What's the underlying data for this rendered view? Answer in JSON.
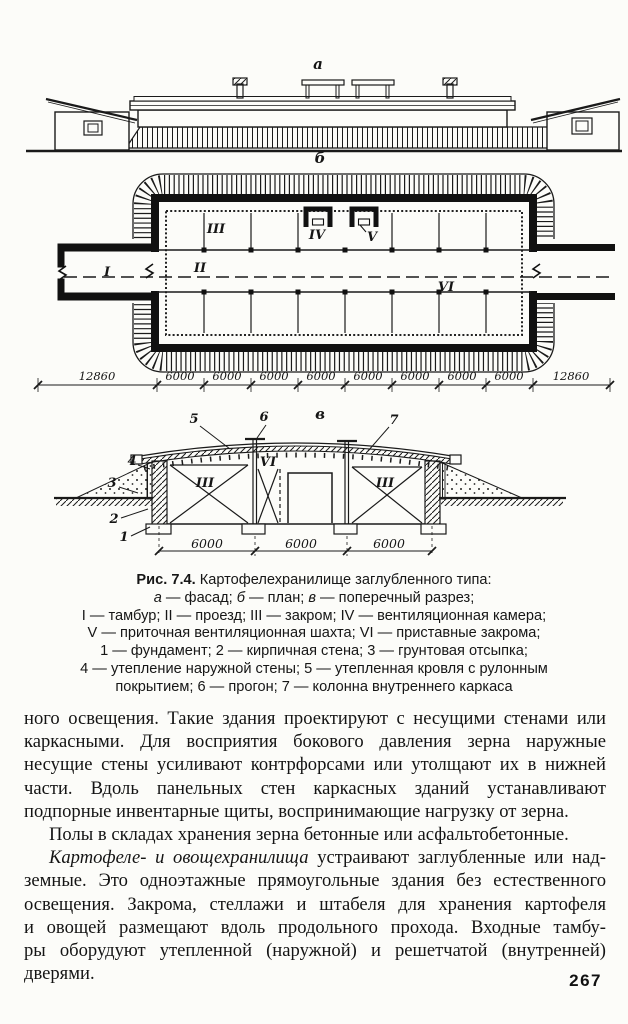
{
  "figure": {
    "view_a": "а",
    "view_b": "б",
    "view_v": "в",
    "plan": {
      "I": "I",
      "II": "II",
      "III": "III",
      "IV": "IV",
      "V": "V",
      "VI": "VI"
    },
    "section": {
      "III_left": "III",
      "VI": "VI",
      "III_right": "III",
      "n1": "1",
      "n2": "2",
      "n3": "3",
      "n4": "4",
      "n5": "5",
      "n6": "6",
      "n7": "7"
    },
    "dims_plan": [
      "12860",
      "6000",
      "6000",
      "6000",
      "6000",
      "6000",
      "6000",
      "6000",
      "6000",
      "12860"
    ],
    "dims_section": [
      "6000",
      "6000",
      "6000"
    ]
  },
  "caption": {
    "figure_label": "Рис. 7.4.",
    "figure_title": " Картофелехранилище заглубленного типа:",
    "l2_a": "а",
    "l2_at": " — фасад; ",
    "l2_b": "б",
    "l2_bt": " — план; ",
    "l2_v": "в",
    "l2_vt": " — поперечный разрез;",
    "line3": "I — тамбур; II — проезд; III — закром; IV — вентиляционная камера;",
    "line4": "V — приточная вентиляционная шахта; VI — приставные закрома;",
    "line5": "1 — фундамент; 2 — кирпичная стена; 3 — грунтовая отсыпка;",
    "line6": "4 — утепление наружной стены; 5 — утепленная кровля с рулонным",
    "line7": "покрытием; 6 — прогон; 7 — колонна внутреннего каркаса"
  },
  "body": {
    "l0": "ного освещения. Такие здания проектируют с несущими стенами или",
    "l1": "каркасными. Для восприятия бокового давления зерна наружные",
    "l2": "несущие стены усиливают контрфорсами или утолщают их в нижней",
    "l3": "части. Вдоль панельных стен каркасных зданий устанавливают",
    "l4": "подпорные инвентарные щиты, воспринимающие нагрузку от зерна.",
    "l5": "Полы в складах хранения зерна бетонные или асфальтобетонные.",
    "l6_lead": "Картофеле- и овощехранилища",
    "l6_rest": " устраивают заглубленные или над-",
    "l7": "земные. Это одноэтажные прямоугольные здания без естественного",
    "l8": "освещения. Закрома, стеллажи и штабеля для хранения картофеля",
    "l9": "и овощей размещают вдоль продольного прохода. Входные тамбу-",
    "l10": "ры оборудуют утепленной (наружной) и решетчатой (внутренней)",
    "l11": "дверями."
  },
  "page": {
    "number": "267"
  }
}
